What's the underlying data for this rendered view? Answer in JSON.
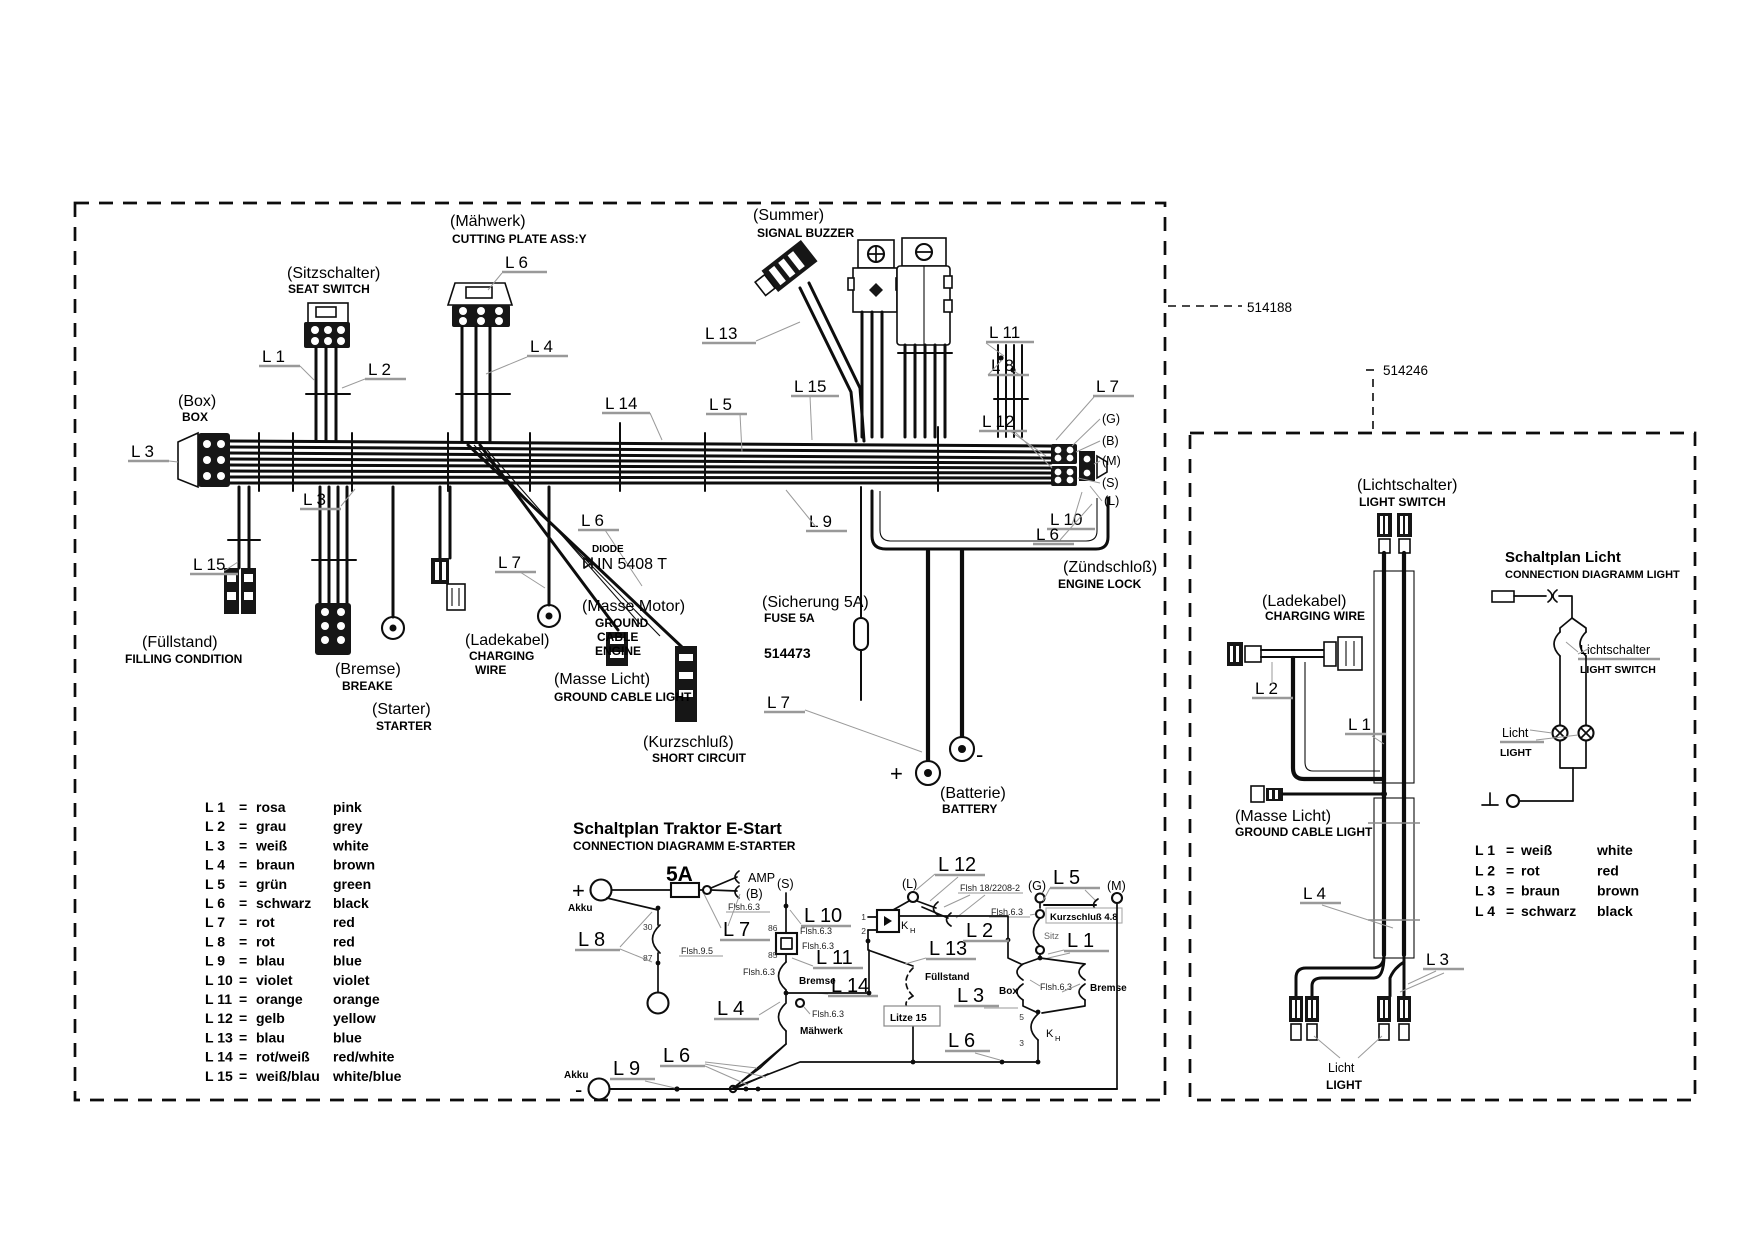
{
  "part_numbers": {
    "main": "514188",
    "light": "514246",
    "fuse": "514473"
  },
  "wire_codes": {
    "L1": "L 1",
    "L2": "L 2",
    "L3": "L 3",
    "L4": "L 4",
    "L5": "L 5",
    "L6": "L 6",
    "L7": "L 7",
    "L8": "L 8",
    "L9": "L 9",
    "L10": "L 10",
    "L11": "L 11",
    "L12": "L 12",
    "L13": "L 13",
    "L14": "L 14",
    "L15": "L 15"
  },
  "devices": {
    "maehwerk": {
      "de": "(Mähwerk)",
      "en": "CUTTING PLATE ASS:Y"
    },
    "sitzschalter": {
      "de": "(Sitzschalter)",
      "en": "SEAT SWITCH"
    },
    "summer": {
      "de": "(Summer)",
      "en": "SIGNAL BUZZER"
    },
    "box": {
      "de": "(Box)",
      "en": "BOX"
    },
    "fuellstand": {
      "de": "(Füllstand)",
      "en": "FILLING CONDITION"
    },
    "bremse": {
      "de": "(Bremse)",
      "en": "BREAKE"
    },
    "starter": {
      "de": "(Starter)",
      "en": "STARTER"
    },
    "ladekabel": {
      "de": "(Ladekabel)",
      "en1": "CHARGING",
      "en2": "WIRE"
    },
    "masse_motor": {
      "de": "(Masse Motor)",
      "en1": "GROUND",
      "en2": "CABLE",
      "en3": "ENGINE"
    },
    "masse_licht": {
      "de": "(Masse Licht)",
      "en": "GROUND CABLE LIGHT"
    },
    "kurzschluss": {
      "de": "(Kurzschluß)",
      "en": "SHORT CIRCUIT"
    },
    "sicherung": {
      "de": "(Sicherung 5A)",
      "en": "FUSE 5A"
    },
    "batterie": {
      "de": "(Batterie)",
      "en": "BATTERY",
      "plus": "+",
      "minus": "-"
    },
    "zuendschloss": {
      "de": "(Zündschloß)",
      "en": "ENGINE LOCK",
      "terminals": [
        "(G)",
        "(B)",
        "(M)",
        "(S)",
        "(L)"
      ]
    },
    "diode": {
      "line1": "DIODE",
      "line2": "IN 5408 T"
    },
    "lichtschalter": {
      "de": "(Lichtschalter)",
      "en": "LIGHT SWITCH"
    },
    "ladekabel_light": {
      "de": "(Ladekabel)",
      "en": "CHARGING WIRE"
    },
    "masse_licht_light": {
      "de": "(Masse Licht)",
      "en": "GROUND CABLE LIGHT"
    },
    "licht_bottom": {
      "de": "Licht",
      "en": "LIGHT"
    }
  },
  "estart": {
    "title": "Schaltplan Traktor E-Start",
    "subtitle": "CONNECTION DIAGRAMM E-STARTER",
    "labels": {
      "akku": "Akku",
      "plus": "+",
      "minus": "-",
      "amp": "AMP",
      "b": "(B)",
      "s": "(S)",
      "l": "(L)",
      "g": "(G)",
      "m": "(M)",
      "fuse": "5A",
      "flsh63": "Flsh.6.3",
      "flsh95": "Flsh.9.5",
      "flsh18": "Flsh 18/2208-2",
      "n30": "30",
      "n87": "87",
      "n86": "86",
      "n85": "85",
      "n1": "1",
      "n2": "2",
      "n5": "5",
      "n3": "3",
      "k": "K",
      "kh": "H",
      "bremse": "Bremse",
      "maehwerk": "Mähwerk",
      "fuellstand": "Füllstand",
      "sitz": "Sitz",
      "box": "Box",
      "kurz48": "Kurzschluß 4.8",
      "litze": "Litze 15"
    }
  },
  "licht_plan": {
    "title": "Schaltplan Licht",
    "subtitle": "CONNECTION DIAGRAMM LIGHT",
    "switch_de": "Lichtschalter",
    "switch_en": "LIGHT SWITCH",
    "licht_de": "Licht",
    "licht_en": "LIGHT"
  },
  "legend_main": {
    "rows": [
      {
        "code": "L 1",
        "eq": "=",
        "de": "rosa",
        "en": "pink"
      },
      {
        "code": "L 2",
        "eq": "=",
        "de": "grau",
        "en": "grey"
      },
      {
        "code": "L 3",
        "eq": "=",
        "de": "weiß",
        "en": "white"
      },
      {
        "code": "L 4",
        "eq": "=",
        "de": "braun",
        "en": "brown"
      },
      {
        "code": "L 5",
        "eq": "=",
        "de": "grün",
        "en": "green"
      },
      {
        "code": "L 6",
        "eq": "=",
        "de": "schwarz",
        "en": "black"
      },
      {
        "code": "L 7",
        "eq": "=",
        "de": "rot",
        "en": "red"
      },
      {
        "code": "L 8",
        "eq": "=",
        "de": "rot",
        "en": "red"
      },
      {
        "code": "L 9",
        "eq": "=",
        "de": "blau",
        "en": "blue"
      },
      {
        "code": "L 10",
        "eq": "=",
        "de": "violet",
        "en": "violet"
      },
      {
        "code": "L 11",
        "eq": "=",
        "de": "orange",
        "en": "orange"
      },
      {
        "code": "L 12",
        "eq": "=",
        "de": "gelb",
        "en": "yellow"
      },
      {
        "code": "L 13",
        "eq": "=",
        "de": "blau",
        "en": "blue"
      },
      {
        "code": "L 14",
        "eq": "=",
        "de": "rot/weiß",
        "en": "red/white"
      },
      {
        "code": "L 15",
        "eq": "=",
        "de": "weiß/blau",
        "en": "white/blue"
      }
    ]
  },
  "legend_light": {
    "rows": [
      {
        "code": "L 1",
        "eq": "=",
        "de": "weiß",
        "en": "white"
      },
      {
        "code": "L 2",
        "eq": "=",
        "de": "rot",
        "en": "red"
      },
      {
        "code": "L 3",
        "eq": "=",
        "de": "braun",
        "en": "brown"
      },
      {
        "code": "L 4",
        "eq": "=",
        "de": "schwarz",
        "en": "black"
      }
    ]
  }
}
